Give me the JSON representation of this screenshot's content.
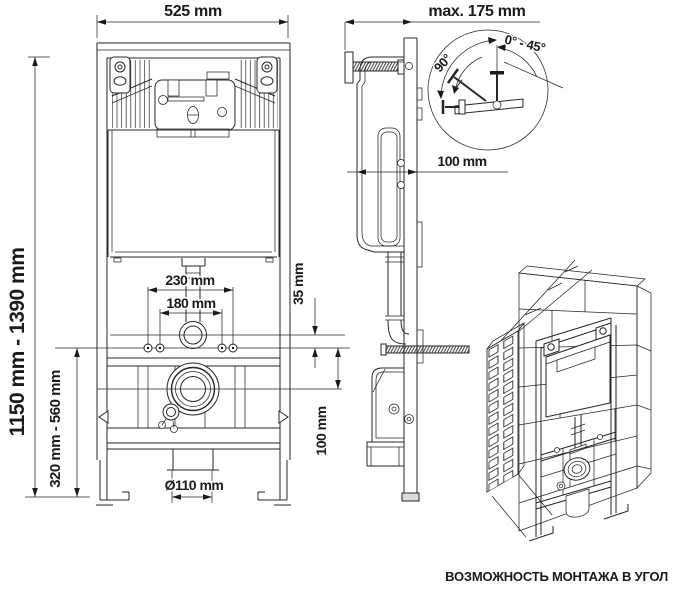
{
  "drawing": {
    "title_semantics": "concealed toilet installation frame technical drawing",
    "front_view": {
      "width": "525 mm",
      "height_range": "1150 mm - 1390 mm",
      "outlet_height_range": "320 mm - 560 mm",
      "bolt_spacing_outer": "230 mm",
      "bolt_spacing_inner": "180 mm",
      "flush_pipe_offset": "35 mm",
      "drain_offset": "100 mm",
      "drain_diameter": "Ø110 mm"
    },
    "side_view": {
      "max_depth": "max. 175 mm",
      "frame_depth": "100 mm"
    },
    "angle_detail": {
      "angle_full": "90°",
      "angle_range": "0° - 45°"
    },
    "caption": "ВОЗМОЖНОСТЬ МОНТАЖА В УГОЛ",
    "colors": {
      "line": "#262626",
      "text": "#1a1a1a",
      "background": "#ffffff"
    }
  }
}
